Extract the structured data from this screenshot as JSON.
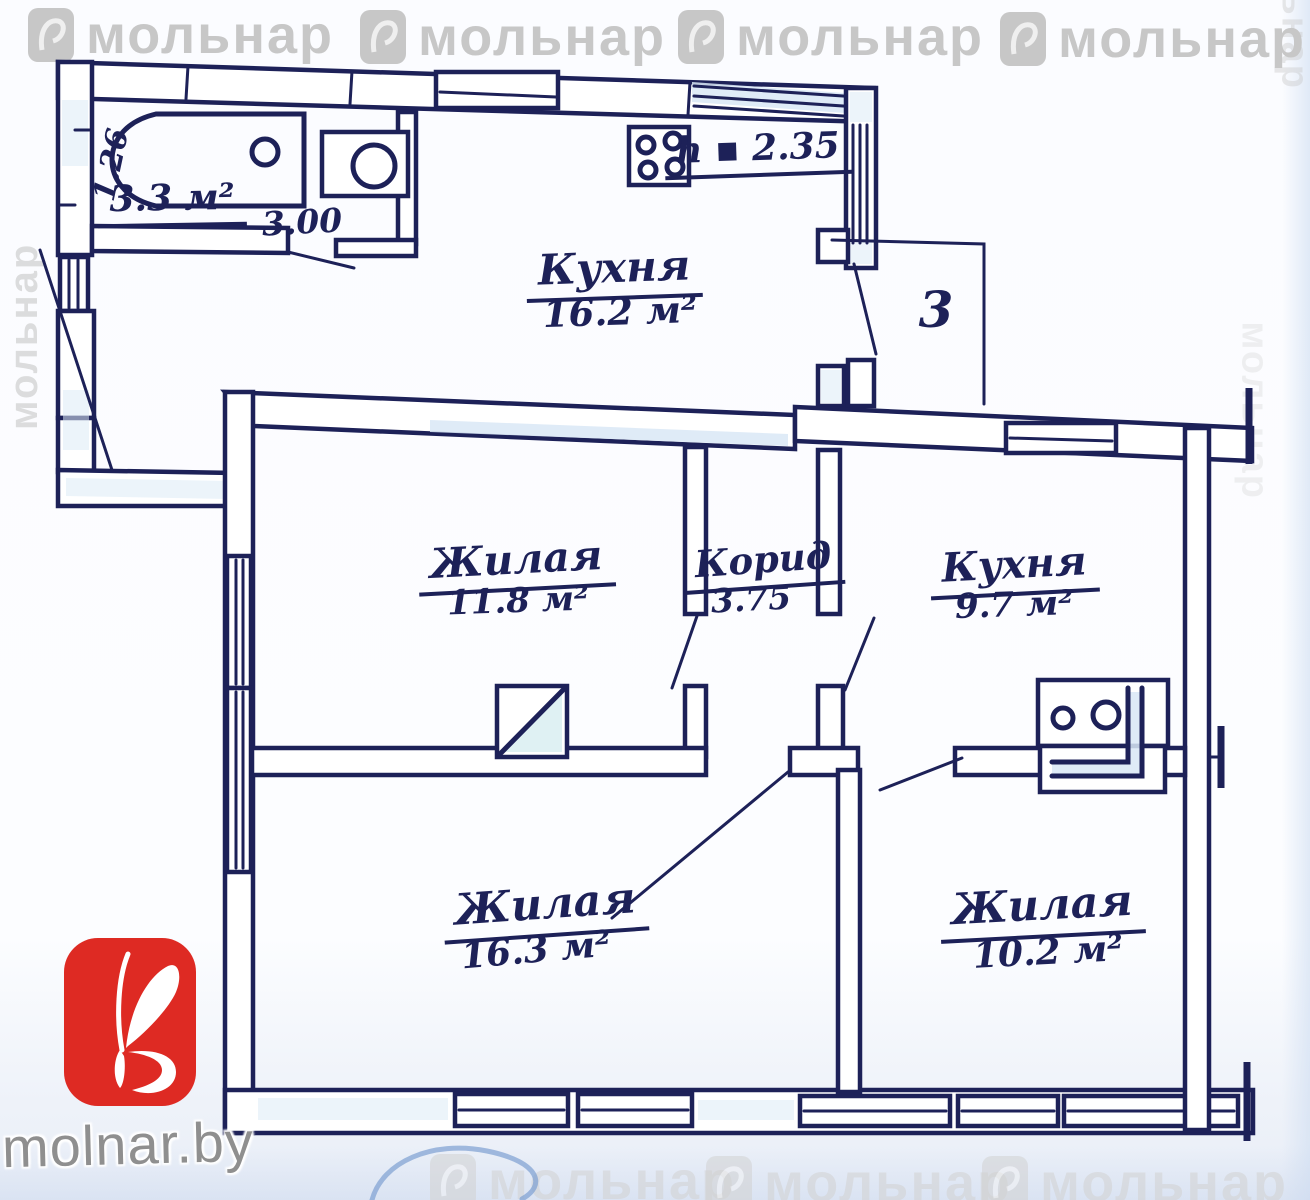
{
  "brand": {
    "watermark_text": "мольнар",
    "site": "molnar.by"
  },
  "floor_plan": {
    "unit_number": "3",
    "ceiling_height": "h ▪ 2.35",
    "bathroom": {
      "area": "3.3 м²",
      "width": "3.00",
      "depth": "1.26"
    },
    "rooms": [
      {
        "name": "Кухня",
        "area": "16.2 м²"
      },
      {
        "name": "Жилая",
        "area": "11.8 м²"
      },
      {
        "name": "Корид",
        "area": "3.75"
      },
      {
        "name": "Кухня",
        "area": "9.7 м²"
      },
      {
        "name": "Жилая",
        "area": "16.3 м²"
      },
      {
        "name": "Жилая",
        "area": "10.2 м²"
      }
    ],
    "fixtures": [
      "bathtub",
      "washbasin",
      "stove",
      "kitchen-sink",
      "built-in-closet"
    ]
  },
  "colors": {
    "ink": "#1d2158",
    "paper": "#fbfcff",
    "wall_tint": "#d9e7f6",
    "logo_red": "#de2a23",
    "watermark_gray": "#c7c7c7",
    "pen_blue": "#7d9fd2"
  }
}
